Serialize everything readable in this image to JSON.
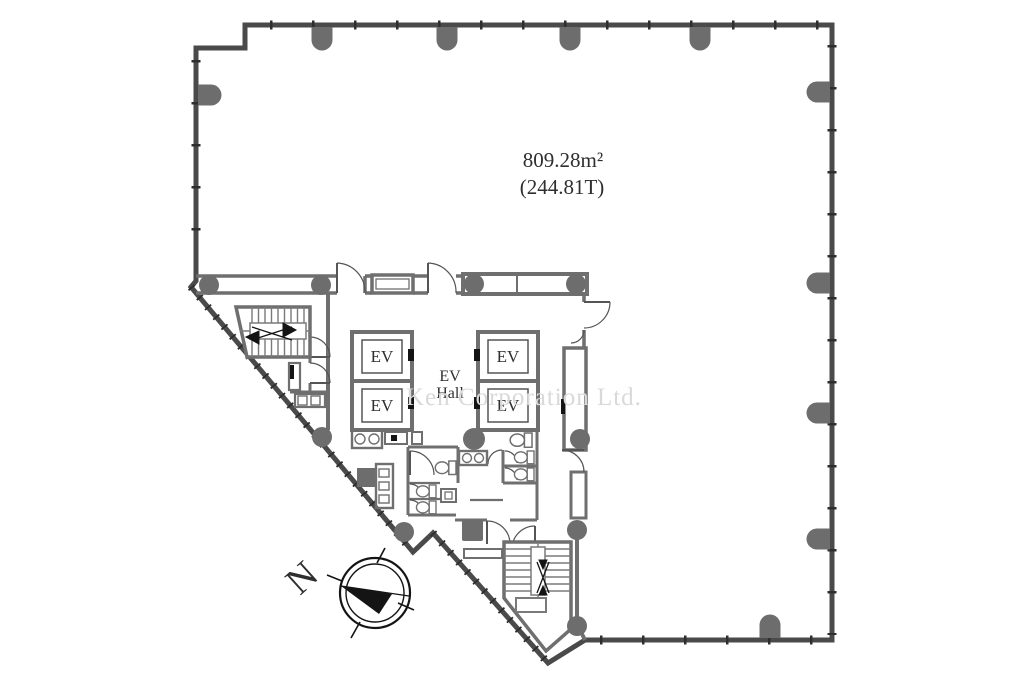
{
  "plan": {
    "area_label": {
      "line1": "809.28m²",
      "line2": "(244.81T)"
    },
    "elevators": {
      "labels": [
        "EV",
        "EV",
        "EV",
        "EV"
      ],
      "hall": {
        "line1": "EV",
        "line2": "Hall"
      }
    }
  },
  "compass": {
    "north_label": "N"
  },
  "watermark": {
    "text": "Ken Corporation Ltd."
  },
  "colors": {
    "exterior_wall": "#4a4a4a",
    "interior_wall": "#6f6f6f",
    "column": "#6d6d6d",
    "text": "#2f2f2f",
    "watermark": "#d9d9d9"
  }
}
